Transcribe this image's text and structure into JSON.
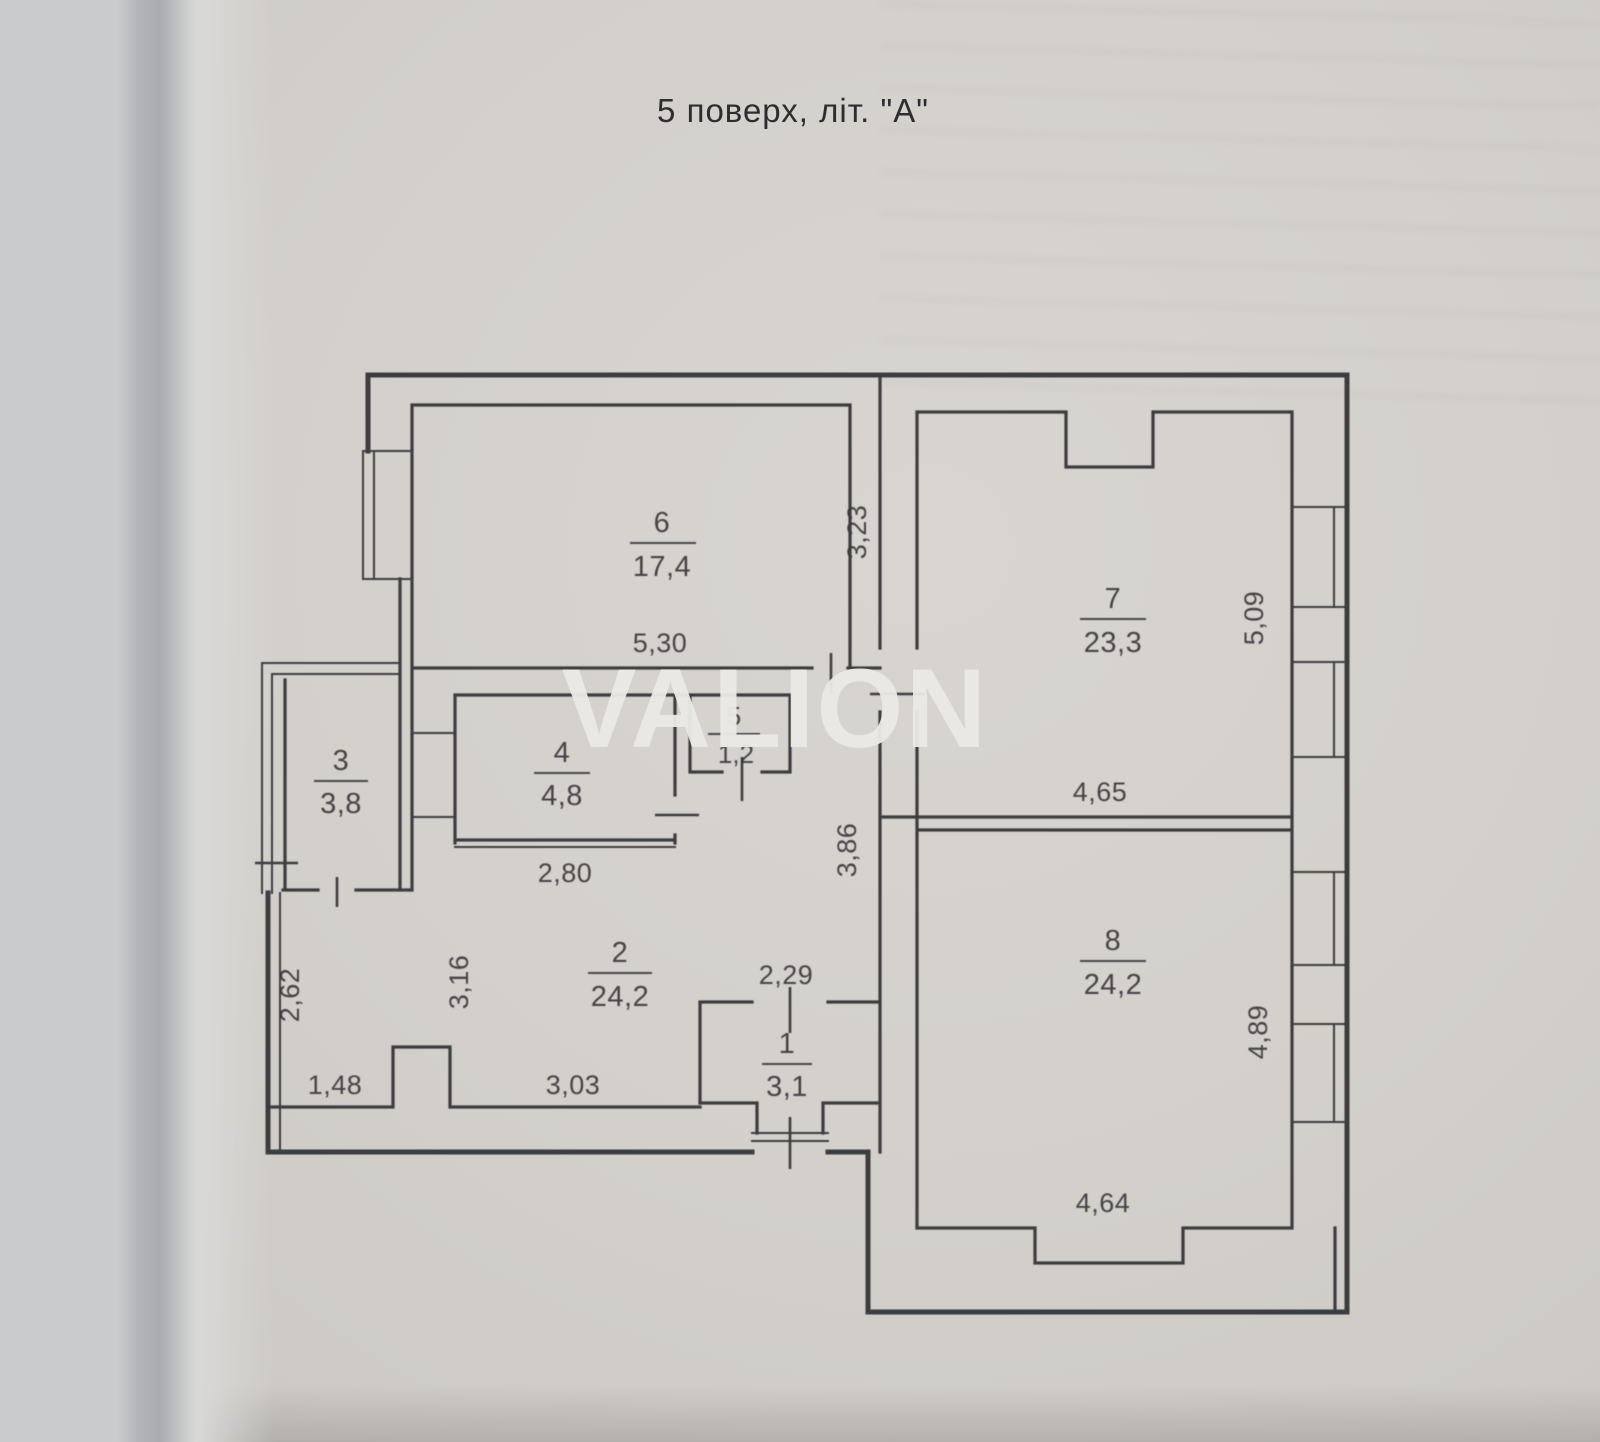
{
  "page": {
    "title": "5 поверх, літ. \"А\"",
    "watermark": "VALION"
  },
  "rooms": {
    "r1": {
      "number": "1",
      "area": "3,1"
    },
    "r2": {
      "number": "2",
      "area": "24,2"
    },
    "r3": {
      "number": "3",
      "area": "3,8"
    },
    "r4": {
      "number": "4",
      "area": "4,8"
    },
    "r5": {
      "number": "5",
      "area": "1,2"
    },
    "r6": {
      "number": "6",
      "area": "17,4"
    },
    "r7": {
      "number": "7",
      "area": "23,3"
    },
    "r8": {
      "number": "8",
      "area": "24,2"
    }
  },
  "dims": {
    "room6_width": "5,30",
    "wall_6_7": "3,23",
    "room7_height": "5,09",
    "room7_width": "4,65",
    "room4_width": "2,80",
    "corridor_height": "3,86",
    "left_lower_height": "2,62",
    "hall_left_height": "3,16",
    "left_bottom_width": "1,48",
    "hall_bottom_width": "3,03",
    "room1_width": "2,29",
    "room8_height": "4,89",
    "room8_width": "4,64"
  },
  "colors": {
    "paper": "#d3d0cb",
    "line": "#3e3d3f",
    "text": "#39383a",
    "watermark": "#e9e8e3"
  }
}
